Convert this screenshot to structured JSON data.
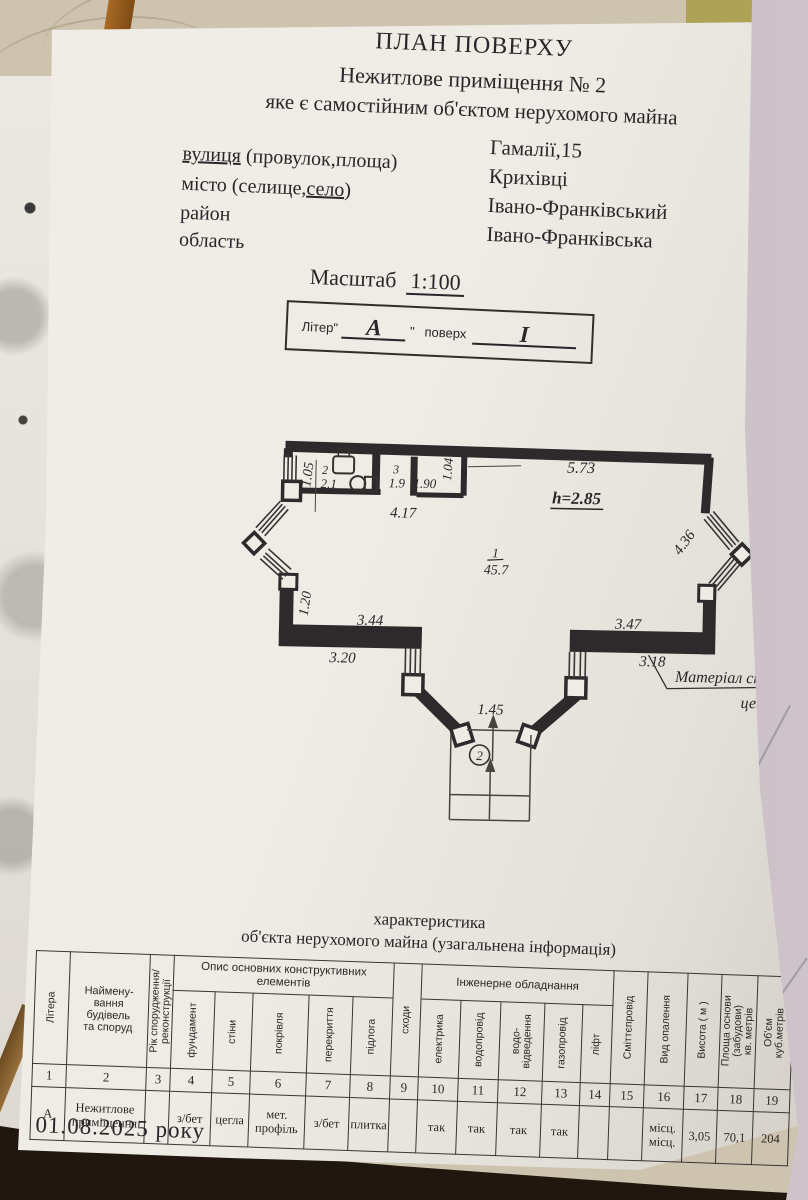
{
  "colors": {
    "paper": "#efece6",
    "ink": "#2a2528",
    "plan_line": "#38322f",
    "background_top": "#cdc3ae",
    "background_dark": "#20180f",
    "second_page": "#c2b8bd",
    "wood": "#8a5a28",
    "olive": "#ada255"
  },
  "header": {
    "title": "ПЛАН ПОВЕРХУ",
    "line1": "Нежитлове приміщення № 2",
    "line2": "яке є самостійним об'єктом нерухомого майна",
    "street_label_u": "вулиця",
    "street_label_rest": " (провулок,площа)",
    "city_label_pre": "місто (селище,",
    "city_label_u": "село",
    "city_label_post": ")",
    "district_label": "район",
    "region_label": "область",
    "street_value": "Гамалії,15",
    "city_value": "Крихівці",
    "district_value": "Івано-Франківський",
    "region_value": "Івано-Франківська",
    "scale_label": "Масштаб",
    "scale_value": "1:100",
    "liter_label": "Літер",
    "liter_quote_open": "\"",
    "liter_value": "А",
    "liter_quote_close": "\"",
    "floor_label": "поверх",
    "floor_value": "I"
  },
  "plan": {
    "dims": {
      "d105": "1.05",
      "d417": "4.17",
      "d190": "1.90",
      "d104": "1.04",
      "d573": "5.73",
      "h": "h=2.85",
      "d436": "4.36",
      "d120": "1.20",
      "d344": "3.44",
      "d320": "3.20",
      "d347": "3.47",
      "d318": "3.18",
      "d145": "1.45"
    },
    "rooms": {
      "r1_num": "1",
      "r1_area": "45.7",
      "r2_num": "2",
      "r2_area": "2.1",
      "r3_num": "3",
      "r3_area": "1.9"
    },
    "entrance_num": "2",
    "material_note_1": "Матеріал ст",
    "material_note_2": "цегл"
  },
  "table": {
    "title1": "характеристика",
    "title2": "об'єкта нерухомого майна (узагальнена інформація)",
    "group1": "Опис основних\nконструктивних елементів",
    "group2": "Інженерне обладнання",
    "columns": [
      {
        "num": "1",
        "label": "Літера",
        "orient": "v",
        "w": 34,
        "group": 0,
        "value": "А"
      },
      {
        "num": "2",
        "label": "Наймену-\nвання\nбудівель\nта споруд",
        "orient": "h",
        "w": 80,
        "group": 0,
        "value": "Нежитлове\nприміщення"
      },
      {
        "num": "3",
        "label": "Рік спорудження/\nреконструкції",
        "orient": "v",
        "w": 24,
        "group": 0,
        "value": ""
      },
      {
        "num": "4",
        "label": "фундамент",
        "orient": "v",
        "w": 42,
        "group": 1,
        "value": "з/бет"
      },
      {
        "num": "5",
        "label": "стіни",
        "orient": "v",
        "w": 38,
        "group": 1,
        "value": "цегла"
      },
      {
        "num": "6",
        "label": "покрівля",
        "orient": "v",
        "w": 56,
        "group": 1,
        "value": "мет.\nпрофіль"
      },
      {
        "num": "7",
        "label": "перекриття",
        "orient": "v",
        "w": 44,
        "group": 1,
        "value": "з/бет"
      },
      {
        "num": "8",
        "label": "підлога",
        "orient": "v",
        "w": 40,
        "group": 1,
        "value": "плитка"
      },
      {
        "num": "9",
        "label": "сходи",
        "orient": "v",
        "w": 28,
        "group": 0,
        "value": ""
      },
      {
        "num": "10",
        "label": "електрика",
        "orient": "v",
        "w": 40,
        "group": 2,
        "value": "так"
      },
      {
        "num": "11",
        "label": "водопровід",
        "orient": "v",
        "w": 40,
        "group": 2,
        "value": "так"
      },
      {
        "num": "12",
        "label": "водо-\nвідведення",
        "orient": "v",
        "w": 44,
        "group": 2,
        "value": "так"
      },
      {
        "num": "13",
        "label": "газопровід",
        "orient": "v",
        "w": 38,
        "group": 2,
        "value": "так"
      },
      {
        "num": "14",
        "label": "ліфт",
        "orient": "v",
        "w": 30,
        "group": 2,
        "value": ""
      },
      {
        "num": "15",
        "label": "Сміттєпровід",
        "orient": "v",
        "w": 34,
        "group": 0,
        "value": ""
      },
      {
        "num": "16",
        "label": "Вид опалення",
        "orient": "v",
        "w": 40,
        "group": 0,
        "value": "місц.\nмісц."
      },
      {
        "num": "17",
        "label": "Висота ( м )",
        "orient": "v",
        "w": 34,
        "group": 0,
        "value": "3,05"
      },
      {
        "num": "18",
        "label": "Площа основи\n(забудови)\nкв. метрів",
        "orient": "v",
        "w": 36,
        "group": 0,
        "value": "70,1"
      },
      {
        "num": "19",
        "label": "Об'єм\nкуб.метрів",
        "orient": "v",
        "w": 36,
        "group": 0,
        "value": "204"
      }
    ]
  },
  "footer": {
    "date": "01.08.2025 року"
  }
}
